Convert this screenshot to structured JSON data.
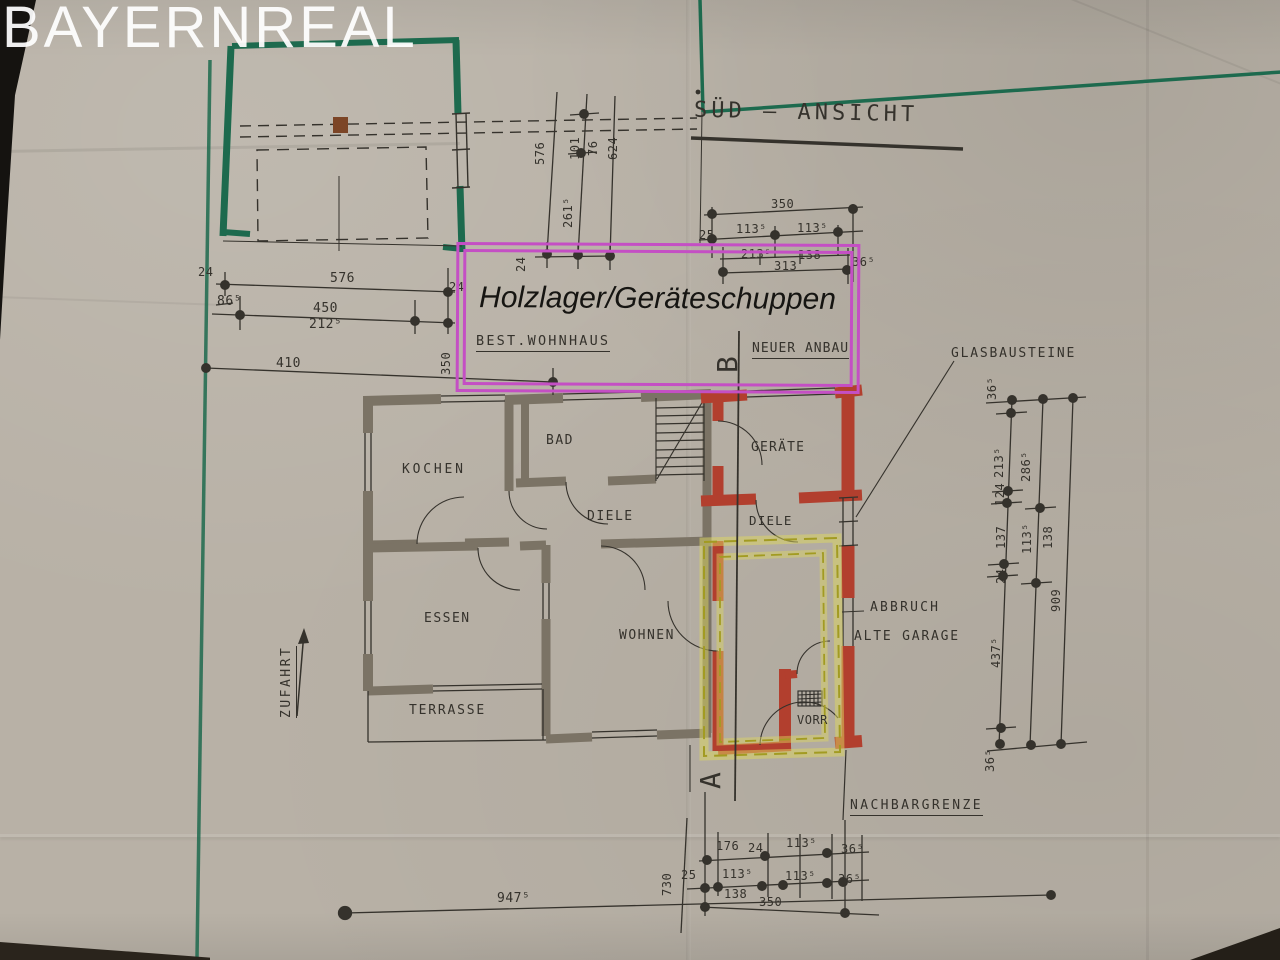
{
  "watermark": "BAYERNREAL",
  "title": {
    "text": "SÜD – ANSICHT"
  },
  "annotation": {
    "text": "Holzlager/Geräteschuppen",
    "border_color": "#c44fc4"
  },
  "colors": {
    "paper": "#b8b1a6",
    "ink": "#35322c",
    "wall_existing_gray": "#7b7365",
    "wall_new_red": "#b23f2e",
    "boundary_green": "#1d6a4e",
    "demolition_yellow": "#ddd85f",
    "demolition_dash": "#a29b22",
    "annotation_pink": "#c44fc4",
    "watermark_white": "#ffffff"
  },
  "plan_labels": [
    {
      "name": "label-best-wohnhaus",
      "text": "BEST.WOHNHAUS",
      "x": 476,
      "y": 333,
      "size": 13.5,
      "ls": 2.2,
      "u": true
    },
    {
      "name": "label-neuer-anbau",
      "text": "NEUER ANBAU",
      "x": 752,
      "y": 341,
      "size": 13,
      "ls": 1,
      "u": true
    },
    {
      "name": "room-label-kochen",
      "text": "KOCHEN",
      "x": 402,
      "y": 462,
      "size": 13,
      "ls": 2.8
    },
    {
      "name": "room-label-bad",
      "text": "BAD",
      "x": 546,
      "y": 433,
      "size": 13,
      "ls": 1.5
    },
    {
      "name": "room-label-diele",
      "text": "DIELE",
      "x": 587,
      "y": 509,
      "size": 13,
      "ls": 1.5
    },
    {
      "name": "room-label-geraete",
      "text": "GERÄTE",
      "x": 751,
      "y": 440,
      "size": 13,
      "ls": 1.2
    },
    {
      "name": "room-label-diele-anbau",
      "text": "DIELE",
      "x": 749,
      "y": 513,
      "size": 12.5,
      "ls": 1.2
    },
    {
      "name": "room-label-essen",
      "text": "ESSEN",
      "x": 424,
      "y": 611,
      "size": 13,
      "ls": 1.5
    },
    {
      "name": "room-label-wohnen",
      "text": "WOHNEN",
      "x": 619,
      "y": 628,
      "size": 13,
      "ls": 1.5
    },
    {
      "name": "room-label-terrasse",
      "text": "TERRASSE",
      "x": 409,
      "y": 703,
      "size": 13,
      "ls": 1.8
    },
    {
      "name": "room-label-vorr",
      "text": "VORR",
      "x": 797,
      "y": 713,
      "size": 12,
      "ls": 0.5
    },
    {
      "name": "label-glasbausteine",
      "text": "GLASBAUSTEINE",
      "x": 951,
      "y": 346,
      "size": 13,
      "ls": 1.8
    },
    {
      "name": "label-abbruch",
      "text": "ABBRUCH",
      "x": 870,
      "y": 600,
      "size": 13,
      "ls": 2.2
    },
    {
      "name": "label-alte-garage",
      "text": "ALTE GARAGE",
      "x": 854,
      "y": 629,
      "size": 13,
      "ls": 1.8
    },
    {
      "name": "label-nachbargrenze",
      "text": "NACHBARGRENZE",
      "x": 850,
      "y": 798,
      "size": 13,
      "ls": 2.4,
      "u": true
    },
    {
      "name": "label-zufahrt",
      "text": "ZUFAHRT",
      "x": 297,
      "y": 716,
      "size": 13,
      "ls": 2.5,
      "u": true,
      "rot": -90
    },
    {
      "name": "section-marker-a",
      "text": "A",
      "x": 727,
      "y": 790,
      "size": 28,
      "rot": -90
    },
    {
      "name": "section-marker-b",
      "text": "B",
      "x": 744,
      "y": 374,
      "size": 28,
      "rot": -90
    }
  ],
  "dimensions": [
    {
      "text": "576",
      "x": 547,
      "y": 165,
      "rot": -90
    },
    {
      "text": "101",
      "x": 582,
      "y": 160,
      "rot": -90
    },
    {
      "text": "76",
      "x": 600,
      "y": 156,
      "rot": -90
    },
    {
      "text": "624",
      "x": 620,
      "y": 160,
      "rot": -90
    },
    {
      "text": "261⁵",
      "x": 575,
      "y": 228,
      "rot": -90
    },
    {
      "text": "24",
      "x": 528,
      "y": 272,
      "rot": -90
    },
    {
      "text": "350",
      "x": 771,
      "y": 197
    },
    {
      "text": "25",
      "x": 699,
      "y": 228
    },
    {
      "text": "113⁵",
      "x": 736,
      "y": 222
    },
    {
      "text": "113⁵",
      "x": 797,
      "y": 221
    },
    {
      "text": "213⁵",
      "x": 741,
      "y": 247
    },
    {
      "text": "138",
      "x": 798,
      "y": 248
    },
    {
      "text": "313",
      "x": 774,
      "y": 259
    },
    {
      "text": "36⁵",
      "x": 852,
      "y": 255
    },
    {
      "text": "24",
      "x": 198,
      "y": 265
    },
    {
      "text": "576",
      "x": 330,
      "y": 271,
      "size": 13
    },
    {
      "text": "24",
      "x": 449,
      "y": 280
    },
    {
      "text": "86⁵",
      "x": 217,
      "y": 294,
      "size": 13
    },
    {
      "text": "450",
      "x": 313,
      "y": 301,
      "size": 13
    },
    {
      "text": "212⁵",
      "x": 309,
      "y": 317,
      "size": 13
    },
    {
      "text": "410",
      "x": 276,
      "y": 356,
      "size": 13
    },
    {
      "text": "350",
      "x": 453,
      "y": 375,
      "rot": -90
    },
    {
      "text": "36⁵",
      "x": 999,
      "y": 400,
      "rot": -90
    },
    {
      "text": "213⁵",
      "x": 1006,
      "y": 478,
      "rot": -90
    },
    {
      "text": "286⁵",
      "x": 1033,
      "y": 482,
      "rot": -90
    },
    {
      "text": "124",
      "x": 1007,
      "y": 506,
      "rot": -90
    },
    {
      "text": "137",
      "x": 1008,
      "y": 549,
      "rot": -90
    },
    {
      "text": "113⁵",
      "x": 1034,
      "y": 554,
      "rot": -90
    },
    {
      "text": "138",
      "x": 1055,
      "y": 549,
      "rot": -90
    },
    {
      "text": "24",
      "x": 1008,
      "y": 584,
      "rot": -90
    },
    {
      "text": "909",
      "x": 1063,
      "y": 612,
      "rot": -90
    },
    {
      "text": "437⁵",
      "x": 1003,
      "y": 668,
      "rot": -90
    },
    {
      "text": "36⁵",
      "x": 997,
      "y": 772,
      "rot": -90
    },
    {
      "text": "730",
      "x": 674,
      "y": 896,
      "rot": -90
    },
    {
      "text": "176",
      "x": 716,
      "y": 839
    },
    {
      "text": "24",
      "x": 748,
      "y": 841
    },
    {
      "text": "113⁵",
      "x": 786,
      "y": 836
    },
    {
      "text": "36⁵",
      "x": 841,
      "y": 842
    },
    {
      "text": "25",
      "x": 681,
      "y": 868
    },
    {
      "text": "113⁵",
      "x": 722,
      "y": 867
    },
    {
      "text": "113⁵",
      "x": 785,
      "y": 869
    },
    {
      "text": "36⁵",
      "x": 838,
      "y": 872
    },
    {
      "text": "138",
      "x": 724,
      "y": 887
    },
    {
      "text": "350",
      "x": 759,
      "y": 895
    },
    {
      "text": "947⁵",
      "x": 497,
      "y": 891,
      "size": 13
    }
  ]
}
